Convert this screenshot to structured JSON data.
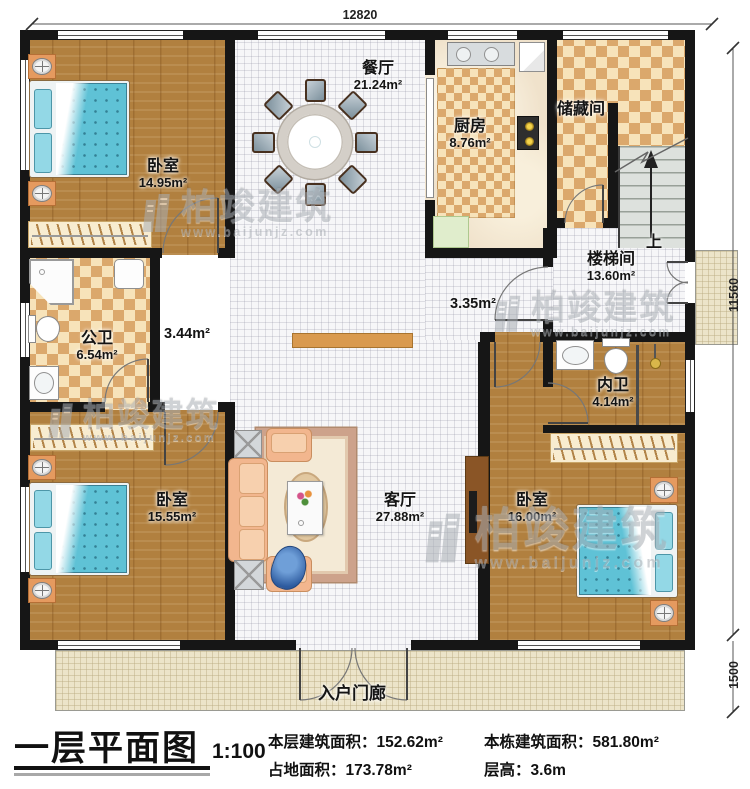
{
  "dimensions": {
    "top": "12820",
    "right": "11560",
    "porch_right": "1500"
  },
  "rooms": {
    "bedroom_top_left": {
      "name": "卧室",
      "area": "14.95m²"
    },
    "dining": {
      "name": "餐厅",
      "area": "21.24m²"
    },
    "kitchen": {
      "name": "厨房",
      "area": "8.76m²"
    },
    "storage": {
      "name": "储藏间"
    },
    "stairwell": {
      "name": "楼梯间",
      "area": "13.60m²",
      "up_label": "上"
    },
    "hallway_left_area": "3.44m²",
    "hallway_right_area": "3.35m²",
    "public_bathroom": {
      "name": "公卫",
      "area": "6.54m²"
    },
    "private_bathroom": {
      "name": "内卫",
      "area": "4.14m²"
    },
    "living": {
      "name": "客厅",
      "area": "27.88m²"
    },
    "bedroom_bottom_left": {
      "name": "卧室",
      "area": "15.55m²"
    },
    "bedroom_bottom_right": {
      "name": "卧室",
      "area": "16.00m²"
    },
    "entrance_porch": {
      "name": "入户门廊"
    }
  },
  "watermark": {
    "brand": "柏竣建筑",
    "url": "www.baijunjz.com"
  },
  "title_block": {
    "title": "一层平面图",
    "scale": "1:100",
    "floor_area_label": "本层建筑面积：",
    "floor_area_value": "152.62m²",
    "building_area_label": "本栋建筑面积：",
    "building_area_value": "581.80m²",
    "footprint_label": "占地面积：",
    "footprint_value": "173.78m²",
    "storey_height_label": "层高：",
    "storey_height_value": "3.6m"
  },
  "colors": {
    "wall": "#161616",
    "wood_floor": "#b1803f",
    "tile_floor": "#f6f6f8",
    "checker_floor": "#f7e3ba",
    "bed_accent": "#5fc2d6",
    "porch_floor": "#ece4c9"
  }
}
